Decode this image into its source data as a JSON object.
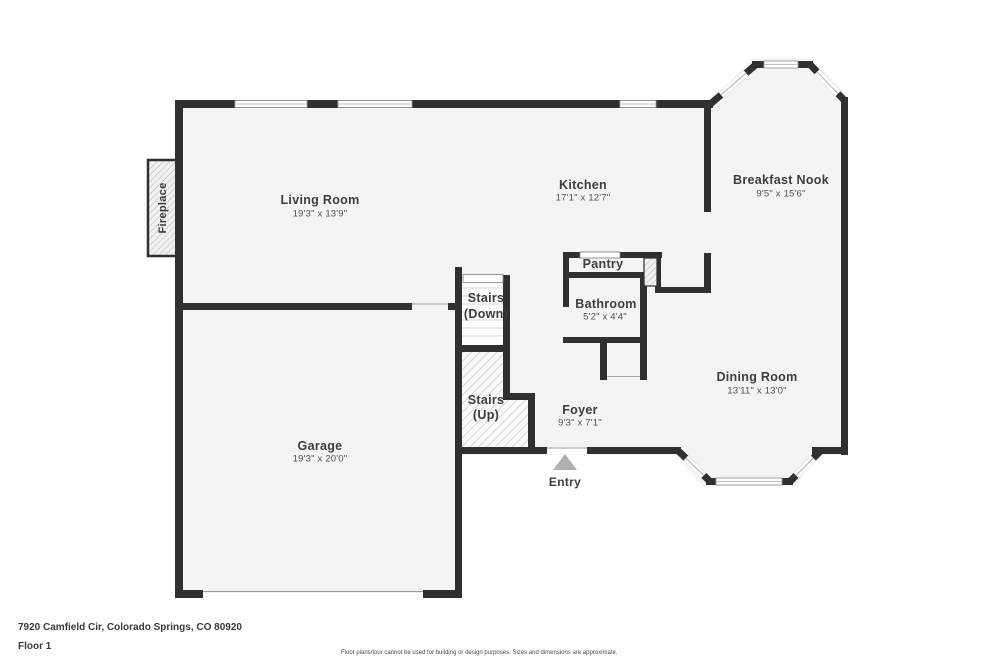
{
  "meta": {
    "address": "7920 Camfield Cir, Colorado Springs, CO 80920",
    "floor": "Floor 1",
    "disclaimer": "Floor plans/tour cannot be used for building or design purposes. Sizes and dimensions are approximate."
  },
  "rooms": {
    "living_room": {
      "name": "Living Room",
      "dims": "19'3\" x 13'9\""
    },
    "kitchen": {
      "name": "Kitchen",
      "dims": "17'1\" x 12'7\""
    },
    "breakfast_nook": {
      "name": "Breakfast Nook",
      "dims": "9'5\" x 15'6\""
    },
    "pantry": {
      "name": "Pantry"
    },
    "bathroom": {
      "name": "Bathroom",
      "dims": "5'2\" x 4'4\""
    },
    "stairs_down": {
      "name": "Stairs",
      "sub": "(Down)"
    },
    "stairs_up": {
      "name": "Stairs",
      "sub": "(Up)"
    },
    "foyer": {
      "name": "Foyer",
      "dims": "9'3\" x 7'1\""
    },
    "dining_room": {
      "name": "Dining Room",
      "dims": "13'11\" x 13'0\""
    },
    "garage": {
      "name": "Garage",
      "dims": "19'3\" x 20'0\""
    },
    "fireplace": {
      "name": "Fireplace"
    },
    "entry": {
      "name": "Entry"
    }
  },
  "colors": {
    "wall": "#303030",
    "floor_fill": "#f4f4f4",
    "entry_arrow": "#b0b0b0"
  }
}
